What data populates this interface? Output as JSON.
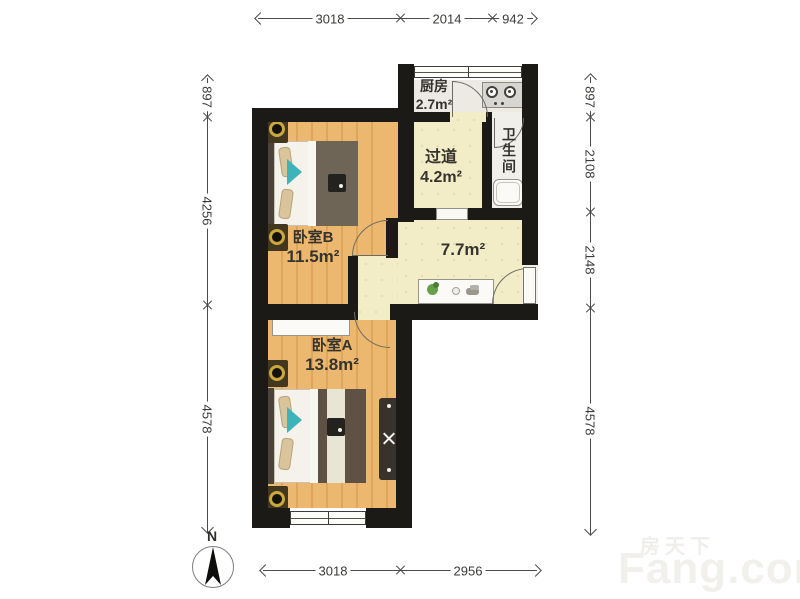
{
  "image_type": "apartment floor plan",
  "rooms": {
    "kitchen": {
      "name": "厨房",
      "area": "2.7m²"
    },
    "hallway": {
      "name": "过道",
      "area": "4.2m²"
    },
    "bathroom": {
      "name": "卫生间"
    },
    "bedroom_b": {
      "name": "卧室B",
      "area": "11.5m²"
    },
    "living": {
      "area": "7.7m²"
    },
    "bedroom_a": {
      "name": "卧室A",
      "area": "13.8m²"
    }
  },
  "dimensions": {
    "top": {
      "d1": "3018",
      "d2": "2014",
      "d3": "942"
    },
    "bottom": {
      "d1": "3018",
      "d2": "2956"
    },
    "left": {
      "d1": "897",
      "d2": "4256",
      "d3": "4578"
    },
    "right": {
      "d1": "897",
      "d2": "2108",
      "d3": "2148",
      "d4": "4578"
    }
  },
  "compass": {
    "label": "N"
  },
  "watermark": {
    "brand_cn": "房天下",
    "brand_en": "Fang.com"
  },
  "colors": {
    "wall": "#1b1a17",
    "wood_floor": "#ecb76e",
    "pale_floor": "#f2ecc7",
    "tile_floor": "#eceae3",
    "accent_teal": "#3fb3ba",
    "nightstand_gold": "#c9a83e"
  }
}
